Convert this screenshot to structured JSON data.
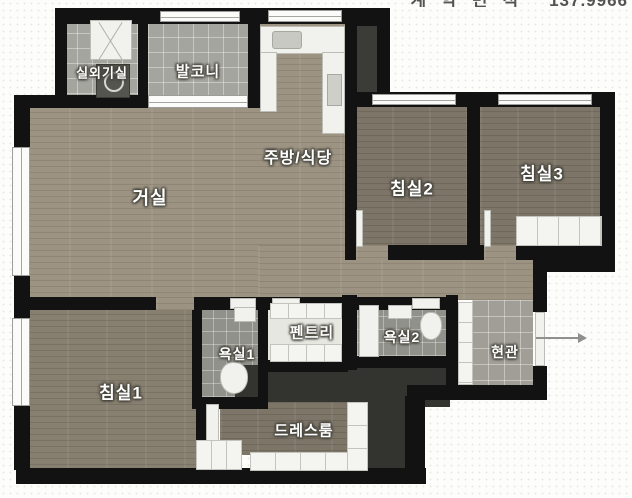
{
  "header": {
    "area_label_korean": "계약면적",
    "area_value": "137.9966"
  },
  "rooms": {
    "outdoor_unit": {
      "label": "실외기실"
    },
    "balcony": {
      "label": "발코니"
    },
    "kitchen": {
      "label": "주방/식당"
    },
    "living": {
      "label": "거실"
    },
    "bedroom2": {
      "label": "침실2"
    },
    "bedroom3": {
      "label": "침실3"
    },
    "bedroom1": {
      "label": "침실1"
    },
    "bath1": {
      "label": "욕실1"
    },
    "pantry": {
      "label": "펜트리"
    },
    "bath2": {
      "label": "욕실2"
    },
    "entrance": {
      "label": "현관"
    },
    "dressroom": {
      "label": "드레스룸"
    }
  },
  "icons": {
    "ac_unit": "outdoor air-conditioner unit",
    "washing_machine": "washer drum",
    "kitchen_sink": "sink with faucet",
    "toilet": "toilet bowl",
    "shower": "shower panel",
    "entrance_arrow": "entry direction arrow"
  },
  "colors": {
    "wall": "#121212",
    "wood_light": "#9c9383",
    "wood_dark": "#7d7568",
    "tile_gray": "#a5a59f",
    "tile_bath": "#91918b",
    "tile_entrance": "#a19e97",
    "pantry_floor": "#e7e7e2",
    "dark_corridor": "#33332f",
    "fixture_white": "#f1f1ee",
    "background": "#fdfdfb",
    "label_text": "#ffffff",
    "arrow": "#90908c"
  }
}
